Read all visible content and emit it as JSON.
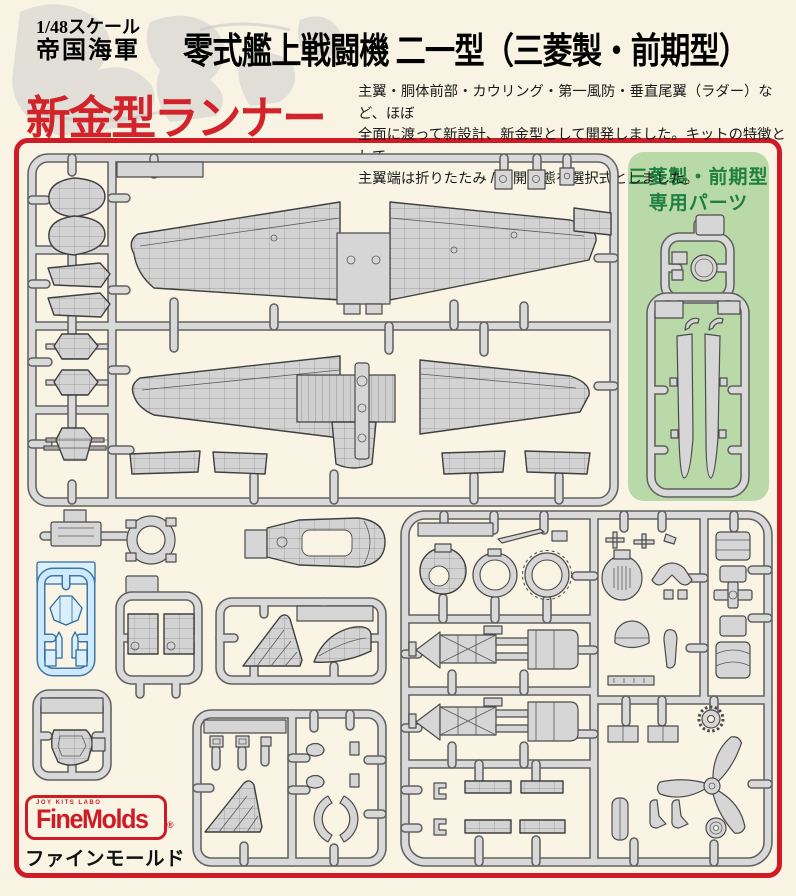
{
  "header": {
    "scale_line1": "1/48スケール",
    "scale_line2": "帝国海軍",
    "title": "零式艦上戦闘機 二一型（三菱製・前期型）",
    "highlight": "新金型ランナー",
    "description_lines": [
      "主翼・胴体前部・カウリング・第一風防・垂直尾翼（ラダー）など、ほぼ",
      "全面に渡って新設計、新金型として開発しました。キットの特徴として、",
      "主翼端は折りたたみ / 展開状態を選択式としました。"
    ]
  },
  "panel": {
    "green_label_line1": "三菱製・前期型",
    "green_label_line2": "専用パーツ"
  },
  "logo": {
    "tagline": "JOY KITS LABO",
    "brand": "FineMolds",
    "registered_mark": "®",
    "brand_jp": "ファインモールド"
  },
  "colors": {
    "accent_red": "#cf1b26",
    "panel_green_bg": "#b9d9a8",
    "panel_green_text": "#1e7f3e",
    "clear_parts_blue": "#dcf0fc",
    "sprue_gray": "#d6d6d6",
    "background_cream": "#f8f3e2"
  }
}
